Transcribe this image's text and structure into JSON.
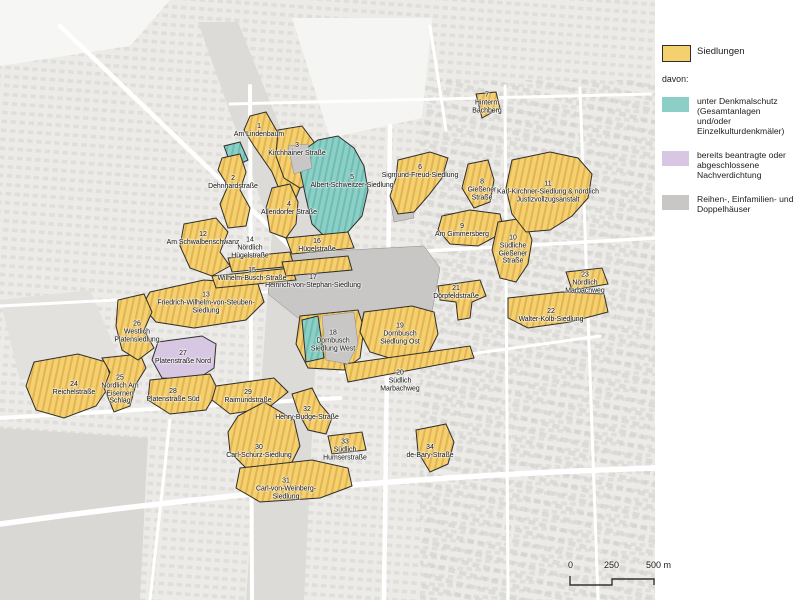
{
  "colors": {
    "siedlung_fill": "#F4D06E",
    "siedlung_stripe": "#E2B453",
    "denkmal_fill": "#8CCFC6",
    "denkmal_stripe": "#6FBDB2",
    "nachverdichtung_fill": "#D8C7E2",
    "reihen_fill": "#C8C7C5",
    "outline": "#2E2E2E",
    "map_base": "#ECEBE8",
    "road": "#FFFFFF",
    "logo_red": "#E3000F"
  },
  "legend": {
    "siedlungen_label": "Siedlungen",
    "davon_label": "davon:",
    "denkmal_lines": [
      "unter Denkmalschutz",
      "(Gesamtanlagen und/oder",
      "Einzelkulturdenkmäler)"
    ],
    "nachverdichtung_lines": [
      "bereits beantragte oder",
      "abgeschlossene",
      "Nachverdichtung"
    ],
    "reihen_lines": [
      "Reihen-, Einfamilien- und",
      "Doppelhäuser"
    ]
  },
  "title_block": {
    "title_lines": [
      "Siedlungen im",
      "\"Mittleren Norden\""
    ],
    "meta_lines": [
      "Maßstab 1:15.000",
      "Stand September 2023",
      "Bearbeitet  Lu/ aK"
    ]
  },
  "scale_bar": {
    "t0": "0",
    "t250": "250",
    "t500": "500 m"
  },
  "map": {
    "bg_patches": [
      {
        "pts": "0,0 170,0 130,46 0,66",
        "fill": "#F6F6F4"
      },
      {
        "pts": "198,22 238,22 322,232 304,600 246,600 272,232",
        "fill": "#DCDBD8"
      },
      {
        "pts": "0,428 148,438 140,600 0,600",
        "fill": "#D9D8D5"
      },
      {
        "pts": "0,300 90,290 120,360 20,380",
        "fill": "#E2E1DE"
      },
      {
        "pts": "292,18 432,18 422,118 330,138",
        "fill": "#F5F5F3"
      }
    ],
    "roads": [
      {
        "d": "M250,86 L252,600",
        "w": 4
      },
      {
        "d": "M390,126 L384,600",
        "w": 4.5
      },
      {
        "d": "M505,86 L508,600",
        "w": 3
      },
      {
        "d": "M60,26 L302,258",
        "w": 4.5
      },
      {
        "d": "M302,258 L655,238",
        "w": 3.5
      },
      {
        "d": "M0,306 L270,292",
        "w": 3
      },
      {
        "d": "M340,372 L600,336",
        "w": 3
      },
      {
        "d": "M0,418 L340,398",
        "w": 4
      },
      {
        "d": "M0,524 Q330,478 655,468",
        "w": 5.5
      },
      {
        "d": "M230,104 L650,94",
        "w": 3
      },
      {
        "d": "M580,88 L598,600",
        "w": 3
      },
      {
        "d": "M430,26 L446,130",
        "w": 3
      },
      {
        "d": "M170,420 L150,600",
        "w": 3
      }
    ],
    "extras": [
      {
        "cat": "reihen",
        "pts": "274,254 424,246 440,268 432,312 378,324 298,318 268,294"
      },
      {
        "cat": "reihen",
        "pts": "444,214 468,212 472,234 450,238"
      },
      {
        "cat": "reihen",
        "pts": "390,198 410,196 414,218 394,222"
      },
      {
        "cat": "reihen",
        "pts": "196,252 216,250 220,268 200,272"
      },
      {
        "cat": "reihen",
        "pts": "320,158 344,154 352,178 346,200 326,202 316,182"
      },
      {
        "cat": "denkmal",
        "pts": "224,146 240,142 248,160 232,168"
      }
    ],
    "settlements": [
      {
        "n": "1",
        "name": "Am Lindenbaum",
        "cat": "siedlung",
        "pts": "250,116 266,112 282,140 300,158 304,178 296,198 282,196 272,172 254,146 244,130",
        "lx": 259,
        "ly": 131,
        "lw": 56
      },
      {
        "n": "2",
        "name": "Dehnhardstraße",
        "cat": "siedlung",
        "pts": "222,158 240,154 246,172 240,190 250,208 246,226 228,228 220,204 228,186 218,170",
        "lx": 233,
        "ly": 183,
        "lw": 82
      },
      {
        "n": "3",
        "name": "Kirchhainer Straße",
        "cat": "siedlung",
        "pts": "278,130 302,126 314,142 312,162 318,180 300,188 284,178 276,156",
        "lx": 297,
        "ly": 150,
        "lw": 60
      },
      {
        "n": "4",
        "name": "Allendorfer Straße",
        "cat": "siedlung",
        "pts": "272,188 290,184 298,202 296,224 286,238 270,232 266,208",
        "lx": 289,
        "ly": 209,
        "lw": 56
      },
      {
        "n": "5",
        "name": "Albert-Schweitzer-Siedlung",
        "cat": "denkmal",
        "pts": "304,150 318,140 338,136 354,148 364,166 368,190 362,216 346,234 326,238 312,224 306,198 300,170",
        "lx": 352,
        "ly": 182,
        "lw": 86
      },
      {
        "n": "6",
        "name": "Sigmund-Freud-Siedlung",
        "cat": "siedlung",
        "pts": "398,160 430,152 448,158 442,178 428,196 414,212 398,214 390,196 396,178",
        "lx": 420,
        "ly": 172,
        "lw": 82
      },
      {
        "n": "7",
        "name": "Hinterm Bachberg",
        "cat": "siedlung",
        "pts": "476,94 496,92 500,108 482,118",
        "lx": 487,
        "ly": 103,
        "lw": 52
      },
      {
        "n": "8",
        "name": "Gießener Straße",
        "cat": "siedlung",
        "pts": "468,164 488,160 494,180 490,202 474,208 462,188",
        "lx": 482,
        "ly": 190,
        "lw": 48
      },
      {
        "n": "9",
        "name": "Am Gimmersberg",
        "cat": "siedlung",
        "pts": "442,216 470,210 500,214 504,232 478,246 450,244 438,230",
        "lx": 462,
        "ly": 231,
        "lw": 70
      },
      {
        "n": "10",
        "name": "Südliche Gießener Straße",
        "cat": "siedlung",
        "pts": "498,222 524,218 532,240 528,264 516,282 500,278 492,250",
        "lx": 513,
        "ly": 250,
        "lw": 50
      },
      {
        "n": "11",
        "name": "Karl-Kirchner-Siedlung & nördlich Justizvollzugsanstalt",
        "cat": "siedlung",
        "pts": "512,160 550,152 578,158 592,174 588,198 572,216 550,230 526,232 512,214 506,188",
        "lx": 548,
        "ly": 192,
        "lw": 110
      },
      {
        "n": "12",
        "name": "Am Schwalbenschwanz",
        "cat": "siedlung",
        "pts": "184,224 216,218 228,232 220,252 230,266 212,276 190,268 180,246",
        "lx": 203,
        "ly": 239,
        "lw": 92
      },
      {
        "n": "13",
        "name": "Friedrich-Wilhelm-von-Steuben-Siedlung",
        "cat": "siedlung",
        "pts": "150,292 204,280 258,284 264,302 246,320 194,328 156,322 142,306",
        "lx": 206,
        "ly": 303,
        "lw": 112
      },
      {
        "n": "14",
        "name": "Nördlich Hügelstraße",
        "cat": "siedlung",
        "pts": "228,258 290,252 294,266 232,272",
        "lx": 250,
        "ly": 248,
        "lw": 56
      },
      {
        "n": "15",
        "name": "Wilhelm-Busch-Straße",
        "cat": "siedlung",
        "pts": "212,276 292,268 296,280 216,288",
        "lx": 252,
        "ly": 275,
        "lw": 82
      },
      {
        "n": "16",
        "name": "Hügelstraße",
        "cat": "siedlung",
        "pts": "286,238 348,232 354,248 292,254",
        "lx": 317,
        "ly": 246,
        "lw": 60
      },
      {
        "n": "17",
        "name": "Heinrich-von-Stephan-Siedlung",
        "cat": "siedlung",
        "pts": "282,262 348,256 352,270 286,276",
        "lx": 313,
        "ly": 282,
        "lw": 112
      },
      {
        "n": "18",
        "name": "Dornbusch Siedlung West",
        "cat": "siedlung",
        "pts": "300,316 358,310 364,328 360,358 344,370 308,368 296,344",
        "lx": 333,
        "ly": 341,
        "lw": 50
      },
      {
        "n": "19",
        "name": "Dornbusch Siedlung Ost",
        "cat": "siedlung",
        "pts": "364,312 412,306 434,312 438,334 428,354 396,360 370,352 360,332",
        "lx": 400,
        "ly": 334,
        "lw": 50
      },
      {
        "n": "20",
        "name": "Südlich Marbachweg",
        "cat": "siedlung",
        "pts": "344,364 470,346 474,358 348,382",
        "lx": 400,
        "ly": 381,
        "lw": 60
      },
      {
        "n": "21",
        "name": "Dörpfeldstraße",
        "cat": "siedlung",
        "pts": "438,286 480,280 486,296 472,302 470,318 458,320 456,302 440,300",
        "lx": 456,
        "ly": 293,
        "lw": 72
      },
      {
        "n": "22",
        "name": "Walter-Kolb-Siedlung",
        "cat": "siedlung",
        "pts": "508,298 562,292 604,294 608,312 570,322 528,328 508,318",
        "lx": 551,
        "ly": 316,
        "lw": 100
      },
      {
        "n": "23",
        "name": "Nördlich Marbachweg",
        "cat": "siedlung",
        "pts": "566,272 602,268 608,284 572,290",
        "lx": 585,
        "ly": 283,
        "lw": 58
      },
      {
        "n": "24",
        "name": "Reichelstraße",
        "cat": "siedlung",
        "pts": "34,362 78,354 106,362 112,382 96,406 64,418 36,410 26,386",
        "lx": 74,
        "ly": 389,
        "lw": 70
      },
      {
        "n": "25",
        "name": "Nördlich Am Eisernen Schlag",
        "cat": "siedlung",
        "pts": "102,358 140,354 146,368 136,384 130,406 114,412 104,388 110,372",
        "lx": 120,
        "ly": 390,
        "lw": 46
      },
      {
        "n": "26",
        "name": "Westlich Platensiedlung",
        "cat": "siedlung",
        "pts": "118,300 144,294 152,312 144,330 154,348 138,360 122,350 116,326",
        "lx": 137,
        "ly": 332,
        "lw": 66
      },
      {
        "n": "27",
        "name": "Platenstraße Nord",
        "cat": "nachverdichtung",
        "pts": "158,342 202,336 216,344 214,368 196,380 162,378 152,360",
        "lx": 183,
        "ly": 358,
        "lw": 60
      },
      {
        "n": "28",
        "name": "Platenstraße Süd",
        "cat": "siedlung",
        "pts": "150,380 210,374 218,390 206,410 170,414 148,400",
        "lx": 173,
        "ly": 396,
        "lw": 60
      },
      {
        "n": "29",
        "name": "Raimundstraße",
        "cat": "siedlung",
        "pts": "216,386 274,378 288,392 268,408 230,414 212,400",
        "lx": 248,
        "ly": 397,
        "lw": 80
      },
      {
        "n": "30",
        "name": "Carl-Schurz-Siedlung",
        "cat": "siedlung",
        "pts": "238,416 264,402 294,420 300,446 290,466 250,472 230,452 228,432",
        "lx": 259,
        "ly": 452,
        "lw": 92
      },
      {
        "n": "31",
        "name": "Carl-von-Weinberg-Siedlung",
        "cat": "siedlung",
        "pts": "240,468 312,460 348,468 352,486 320,498 260,502 236,488",
        "lx": 286,
        "ly": 489,
        "lw": 86
      },
      {
        "n": "32",
        "name": "Henry-Budge-Straße",
        "cat": "siedlung",
        "pts": "292,394 312,388 320,404 332,418 326,434 308,430 298,412",
        "lx": 307,
        "ly": 414,
        "lw": 102
      },
      {
        "n": "33",
        "name": "Südlich Humserstraße",
        "cat": "siedlung",
        "pts": "328,436 362,432 366,450 332,454",
        "lx": 345,
        "ly": 450,
        "lw": 62
      },
      {
        "n": "34",
        "name": "de-Bary-Straße",
        "cat": "siedlung",
        "pts": "416,430 446,424 454,442 448,464 430,472 418,452",
        "lx": 430,
        "ly": 452,
        "lw": 80
      }
    ],
    "overlays": [
      {
        "cat": "denkmal",
        "pts": "302,320 318,316 324,358 306,362"
      },
      {
        "cat": "reihen",
        "pts": "322,316 354,312 358,344 348,364 326,360"
      },
      {
        "cat": "reihen",
        "pts": "288,146 308,144 312,168 294,174"
      }
    ]
  }
}
